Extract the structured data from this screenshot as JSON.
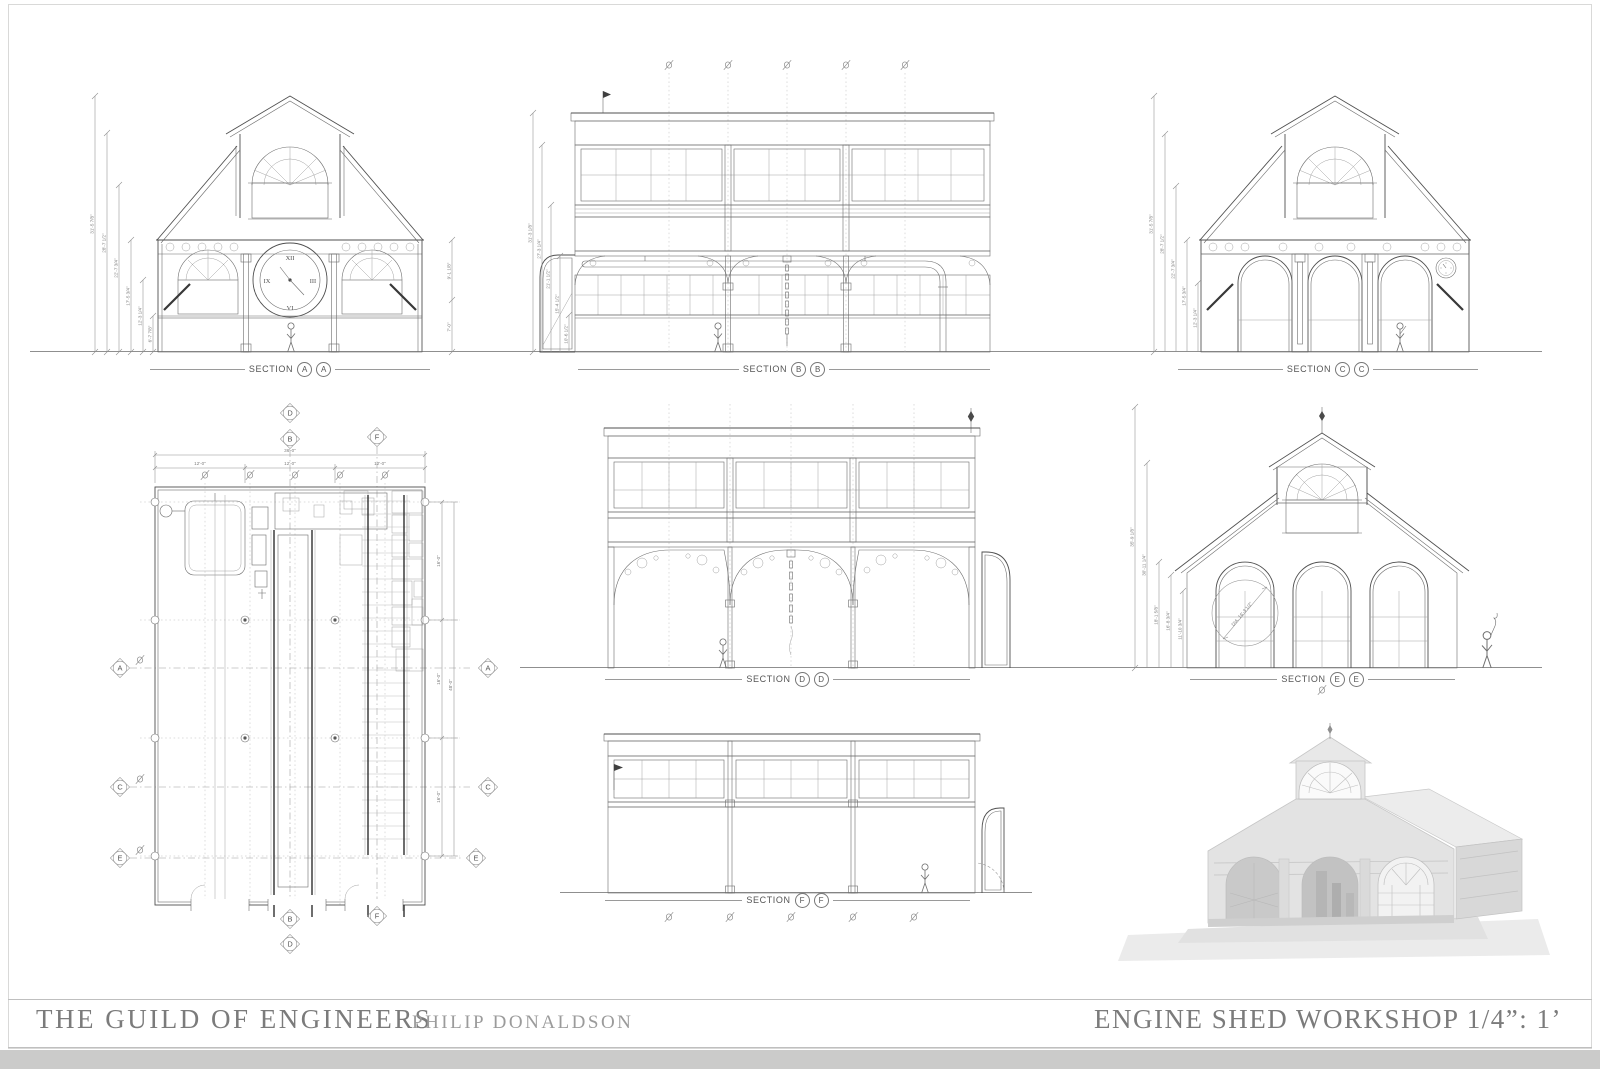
{
  "title_block": {
    "studio": "THE GUILD OF ENGINEERS",
    "author": "PHILIP DONALDSON",
    "drawing_title": "ENGINE SHED WORKSHOP 1/4”: 1’"
  },
  "sections": {
    "aa": {
      "word": "SECTION",
      "a": "A",
      "b": "A"
    },
    "bb": {
      "word": "SECTION",
      "a": "B",
      "b": "B"
    },
    "cc": {
      "word": "SECTION",
      "a": "C",
      "b": "C"
    },
    "dd": {
      "word": "SECTION",
      "a": "D",
      "b": "D"
    },
    "ee": {
      "word": "SECTION",
      "a": "E",
      "b": "E"
    },
    "ff": {
      "word": "SECTION",
      "a": "F",
      "b": "F"
    }
  },
  "clock": {
    "numerals": [
      "XII",
      "I",
      "II",
      "III",
      "IIII",
      "V",
      "VI",
      "VII",
      "VIII",
      "IX",
      "X",
      "XI"
    ]
  },
  "dims": {
    "aa_left": [
      "31'-5 7/8\"",
      "28'-7 1/2\"",
      "22'-7 3/4\"",
      "17'-5 3/4\"",
      "12'-3 1/4\"",
      "6'-7 7/8\""
    ],
    "aa_right": [
      "9'-1 1/8\"",
      "7'-0\""
    ],
    "bb_left": [
      "31'-3 1/8\"",
      "27'-3 1/4\"",
      "21'-1 1/2\"",
      "15'-4 1/2\"",
      "10'-6 1/2\""
    ],
    "cc_left": [
      "31'-5 7/8\"",
      "28'-7 1/2\"",
      "22'-7 3/4\"",
      "17'-5 3/4\"",
      "12'-3 1/4\""
    ],
    "ee_left": [
      "35'-9 1/8\"",
      "30'-11 1/4\"",
      "18'-1 5/8\"",
      "16'-8 3/4\"",
      "11'-10 3/4\""
    ],
    "ee_dia": "DIA. 16'-3 1/2\""
  },
  "plan": {
    "bubbles": {
      "top": [
        "D",
        "B",
        "F"
      ],
      "bottom": [
        "B",
        "D",
        "F"
      ],
      "left": [
        "A",
        "C",
        "E"
      ],
      "right": [
        "A",
        "C",
        "E"
      ]
    },
    "dims": {
      "overall_w": "36'-0\"",
      "bay_w": "12'-0\"",
      "overall_l": "48'-0\"",
      "bay_l": "16'-0\""
    }
  }
}
